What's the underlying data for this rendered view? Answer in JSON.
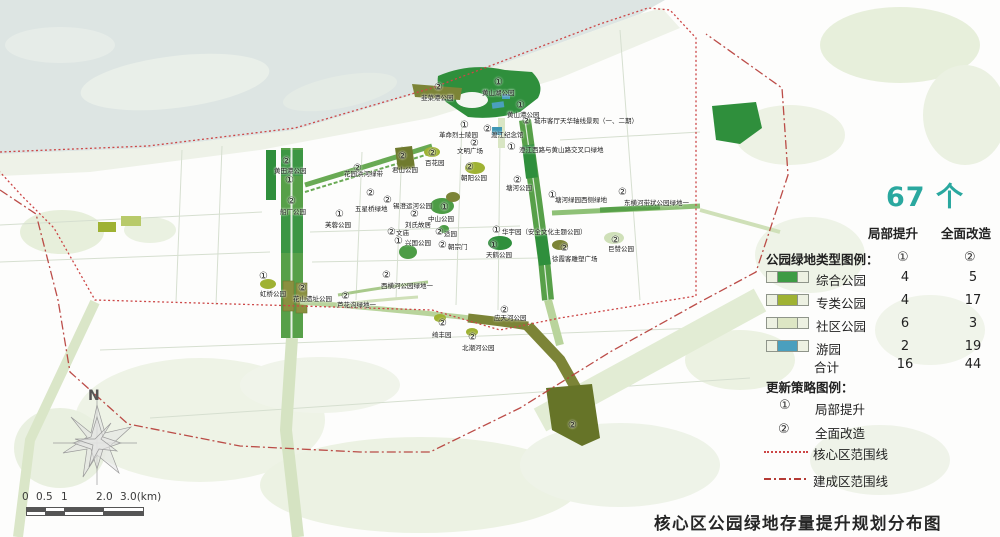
{
  "title": "核心区公园绿地存量提升规划分布图",
  "header": {
    "count_label": "67 个"
  },
  "legend": {
    "col1": "局部提升",
    "col2": "全面改造",
    "col1_mark": "①",
    "col2_mark": "②",
    "type_title": "公园绿地类型图例：",
    "rows": [
      {
        "label": "综合公园",
        "v1": 4,
        "v2": 5,
        "color": "#3d9b44"
      },
      {
        "label": "专类公园",
        "v1": 4,
        "v2": 17,
        "color": "#9fb233"
      },
      {
        "label": "社区公园",
        "v1": 6,
        "v2": 3,
        "color": "#dde6c4"
      },
      {
        "label": "游园",
        "v1": 2,
        "v2": 19,
        "color": "#4a9fbe"
      }
    ],
    "total": {
      "label": "合计",
      "v1": 16,
      "v2": 44
    }
  },
  "strategy": {
    "title": "更新策略图例：",
    "items": [
      {
        "mark": "①",
        "label": "局部提升"
      },
      {
        "mark": "②",
        "label": "全面改造"
      }
    ],
    "lines": [
      {
        "style": "dotted",
        "label": "核心区范围线",
        "color": "#cc4646"
      },
      {
        "style": "dashdot",
        "label": "建成区范围线",
        "color": "#b53a35"
      }
    ]
  },
  "compass": {
    "label": "N"
  },
  "scalebar": {
    "ticks": [
      {
        "t": "0",
        "x": 22
      },
      {
        "t": "0.5",
        "x": 36
      },
      {
        "t": "1",
        "x": 61
      },
      {
        "t": "2.0",
        "x": 96
      },
      {
        "t": "3.0(km)",
        "x": 120
      }
    ]
  },
  "map": {
    "labels": [
      {
        "n": "②",
        "t": "韭菜港公园",
        "nx": 434,
        "ny": 83,
        "tx": 421,
        "ty": 95
      },
      {
        "n": "①",
        "t": "黄山湖公园",
        "nx": 494,
        "ny": 78,
        "tx": 482,
        "ty": 90
      },
      {
        "n": "①",
        "t": "黄山港公园",
        "nx": 516,
        "ny": 101,
        "tx": 507,
        "ty": 112
      },
      {
        "n": "②",
        "t": "城市客厅天华轴线景观（一、二期）",
        "nx": 522,
        "ny": 117,
        "tx": 534,
        "ty": 118
      },
      {
        "n": "②",
        "t": "渡江纪念馆",
        "nx": 483,
        "ny": 125,
        "tx": 491,
        "ty": 132
      },
      {
        "n": "①",
        "t": "革命烈士陵园",
        "nx": 460,
        "ny": 121,
        "tx": 439,
        "ty": 132
      },
      {
        "n": "②",
        "t": "文明广场",
        "nx": 470,
        "ny": 139,
        "tx": 457,
        "ty": 148
      },
      {
        "n": "①",
        "t": "澄江西路与黄山路交叉口绿地",
        "nx": 507,
        "ny": 143,
        "tx": 519,
        "ty": 147
      },
      {
        "n": "②",
        "t": "君山公园",
        "nx": 398,
        "ny": 152,
        "tx": 392,
        "ty": 167
      },
      {
        "n": "②",
        "t": "百花园",
        "nx": 428,
        "ny": 149,
        "tx": 425,
        "ty": 160
      },
      {
        "n": "②",
        "t": "朝阳公园",
        "nx": 465,
        "ny": 163,
        "tx": 461,
        "ty": 175
      },
      {
        "n": "②",
        "t": "花园浜河绿带",
        "nx": 353,
        "ny": 164,
        "tx": 344,
        "ty": 171
      },
      {
        "n": "②",
        "t": "黄田港公园",
        "nx": 282,
        "ny": 157,
        "tx": 274,
        "ty": 168
      },
      {
        "n": "①",
        "t": "",
        "nx": 285,
        "ny": 176,
        "tx": 0,
        "ty": 0
      },
      {
        "n": "②",
        "t": "船厂公园",
        "nx": 287,
        "ny": 197,
        "tx": 280,
        "ty": 209
      },
      {
        "n": "①",
        "t": "芙蓉公园",
        "nx": 335,
        "ny": 210,
        "tx": 325,
        "ty": 222
      },
      {
        "n": "②",
        "t": "五星桥绿地",
        "nx": 366,
        "ny": 189,
        "tx": 355,
        "ty": 206
      },
      {
        "n": "②",
        "t": "锡澄运河公园",
        "nx": 383,
        "ny": 196,
        "tx": 393,
        "ty": 203
      },
      {
        "n": "①",
        "t": "中山公园",
        "nx": 440,
        "ny": 203,
        "tx": 428,
        "ty": 216
      },
      {
        "n": "②",
        "t": "刘氏故居",
        "nx": 410,
        "ny": 210,
        "tx": 405,
        "ty": 222
      },
      {
        "n": "②",
        "t": "文庙",
        "nx": 387,
        "ny": 228,
        "tx": 396,
        "ty": 230
      },
      {
        "n": "①",
        "t": "兴国公园",
        "nx": 394,
        "ny": 237,
        "tx": 405,
        "ty": 240
      },
      {
        "n": "②",
        "t": "适园",
        "nx": 435,
        "ny": 228,
        "tx": 444,
        "ty": 231
      },
      {
        "n": "②",
        "t": "朝宗门",
        "nx": 438,
        "ny": 241,
        "tx": 448,
        "ty": 244
      },
      {
        "n": "①",
        "t": "天鹤公园",
        "nx": 489,
        "ny": 241,
        "tx": 486,
        "ty": 252
      },
      {
        "n": "①",
        "t": "华宇园（安全文化主题公园）",
        "nx": 492,
        "ny": 226,
        "tx": 502,
        "ty": 229
      },
      {
        "n": "②",
        "t": "徐霞客雕塑广场",
        "nx": 560,
        "ny": 244,
        "tx": 552,
        "ty": 256
      },
      {
        "n": "②",
        "t": "巨赞公园",
        "nx": 611,
        "ny": 236,
        "tx": 608,
        "ty": 246
      },
      {
        "n": "②",
        "t": "东横河带状公园绿地一",
        "nx": 618,
        "ny": 188,
        "tx": 624,
        "ty": 200
      },
      {
        "n": "①",
        "t": "塘河绿园西侧绿地",
        "nx": 548,
        "ny": 191,
        "tx": 555,
        "ty": 197
      },
      {
        "n": "②",
        "t": "塘河公园",
        "nx": 513,
        "ny": 176,
        "tx": 506,
        "ty": 185
      },
      {
        "n": "②",
        "t": "西横河公园绿地一",
        "nx": 382,
        "ny": 271,
        "tx": 381,
        "ty": 283
      },
      {
        "n": "②",
        "t": "芦花沟绿地一",
        "nx": 341,
        "ny": 292,
        "tx": 337,
        "ty": 302
      },
      {
        "n": "②",
        "t": "花山遗址公园",
        "nx": 298,
        "ny": 284,
        "tx": 293,
        "ty": 296
      },
      {
        "n": "①",
        "t": "虹桥公园",
        "nx": 259,
        "ny": 272,
        "tx": 260,
        "ty": 291
      },
      {
        "n": "②",
        "t": "应天河公园",
        "nx": 500,
        "ny": 306,
        "tx": 494,
        "ty": 315
      },
      {
        "n": "②",
        "t": "绮丰园",
        "nx": 438,
        "ny": 319,
        "tx": 432,
        "ty": 332
      },
      {
        "n": "②",
        "t": "北潮河公园",
        "nx": 468,
        "ny": 333,
        "tx": 462,
        "ty": 345
      },
      {
        "n": "②",
        "t": "",
        "nx": 568,
        "ny": 421,
        "tx": 0,
        "ty": 0
      }
    ]
  }
}
